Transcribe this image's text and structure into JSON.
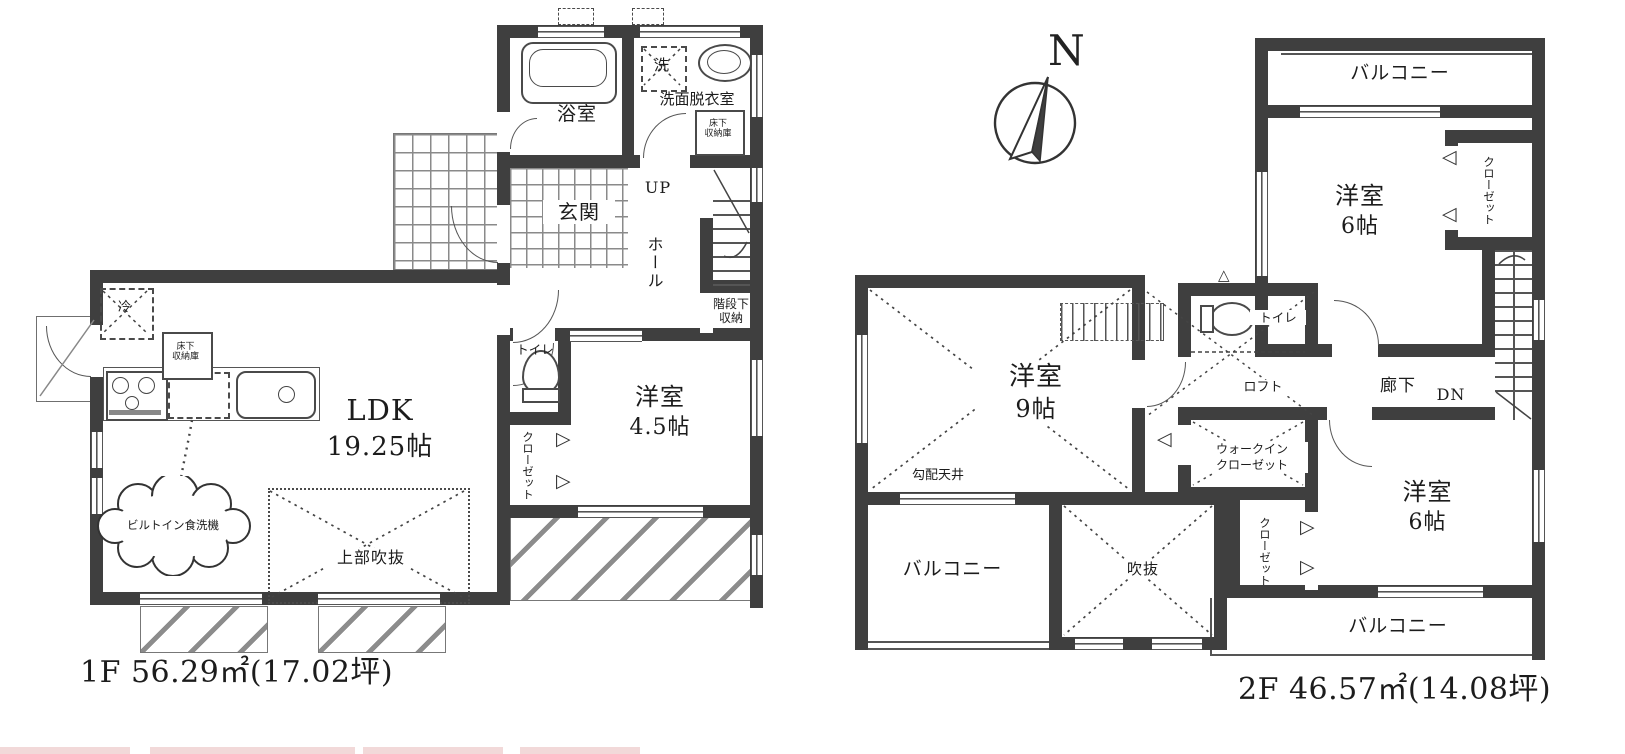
{
  "meta": {
    "bg_color": "#ffffff",
    "wall_color": "#3f3f3f",
    "line_color": "#555555",
    "accent_strip_color": "#f2d9d9"
  },
  "f1": {
    "area": "1F 56.29㎡(17.02坪)",
    "bath": "浴室",
    "laundry": "洗",
    "washroom": "洗面脱衣室",
    "ufs1": "床下",
    "ufs2": "収納庫",
    "genkan": "玄関",
    "up": "UP",
    "hall": "ホール",
    "uss1": "階段下",
    "uss2": "収納",
    "toilet": "トイレ",
    "closet": "クローゼット",
    "west": "洋室",
    "west_size": "4.5帖",
    "ldk": "LDK",
    "ldk_size": "19.25帖",
    "fridge": "冷",
    "kufs1": "床下",
    "kufs2": "収納庫",
    "dishwasher": "ビルトイン食洗機",
    "open_above": "上部吹抜"
  },
  "f2": {
    "area": "2F 46.57㎡(14.08坪)",
    "north": "N",
    "balcony_top": "バルコニー",
    "west6a": "洋室",
    "west6a_size": "6帖",
    "closet_a": "クローゼット",
    "west9": "洋室",
    "west9_size": "9帖",
    "sloped": "勾配天井",
    "toilet": "トイレ",
    "loft": "ロフト",
    "corridor": "廊下",
    "dn": "DN",
    "wic1": "ウォークイン",
    "wic2": "クローゼット",
    "west6b": "洋室",
    "west6b_size": "6帖",
    "closet_b": "クローゼット",
    "balcony_left": "バルコニー",
    "void": "吹抜",
    "balcony_bottom": "バルコニー"
  }
}
